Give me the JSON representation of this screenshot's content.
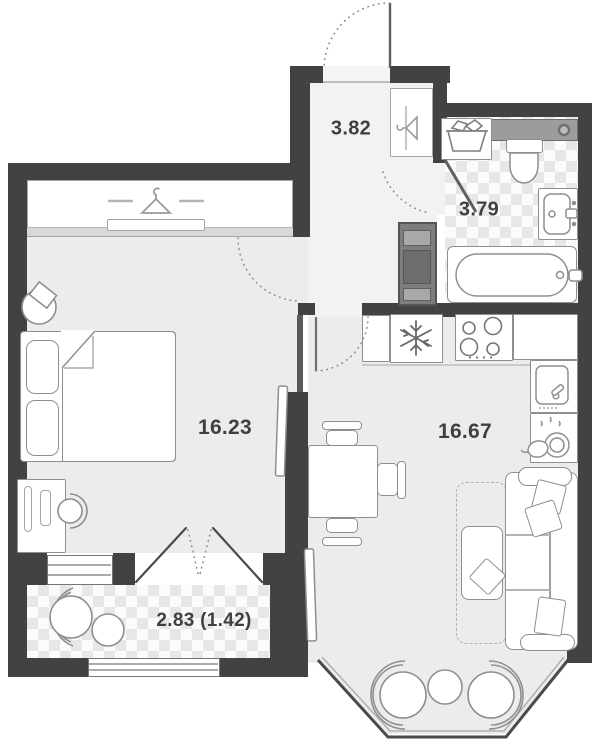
{
  "plan_title": "apartment-floor-plan",
  "rooms": {
    "hallway": {
      "name": "hallway",
      "area": "3.82"
    },
    "bathroom": {
      "name": "bathroom",
      "area": "3.79"
    },
    "bedroom": {
      "name": "bedroom",
      "area": "16.23"
    },
    "living_kitchen": {
      "name": "kitchen-living-room",
      "area": "16.67"
    },
    "balcony": {
      "name": "balcony",
      "area": "2.83 (1.42)"
    }
  },
  "colors": {
    "wall": "#424242",
    "floor": "#ececec",
    "hall_floor": "#f2f2f2",
    "tile_light": "#fbfbfb",
    "tile_dark": "#e7e7e7",
    "furniture_outline": "#8f8f8f",
    "label_text": "#3f3f3f"
  },
  "icons": {
    "hanger-icon": "clothes hanger glyph",
    "snowflake-icon": "fridge snowflake",
    "burners-icon": "4 stove burners",
    "laundry-basket-icon": "basket with clothes",
    "dish-rack-icon": "cup and plates with drops",
    "door-swing-icon": "dotted quarter arc"
  }
}
